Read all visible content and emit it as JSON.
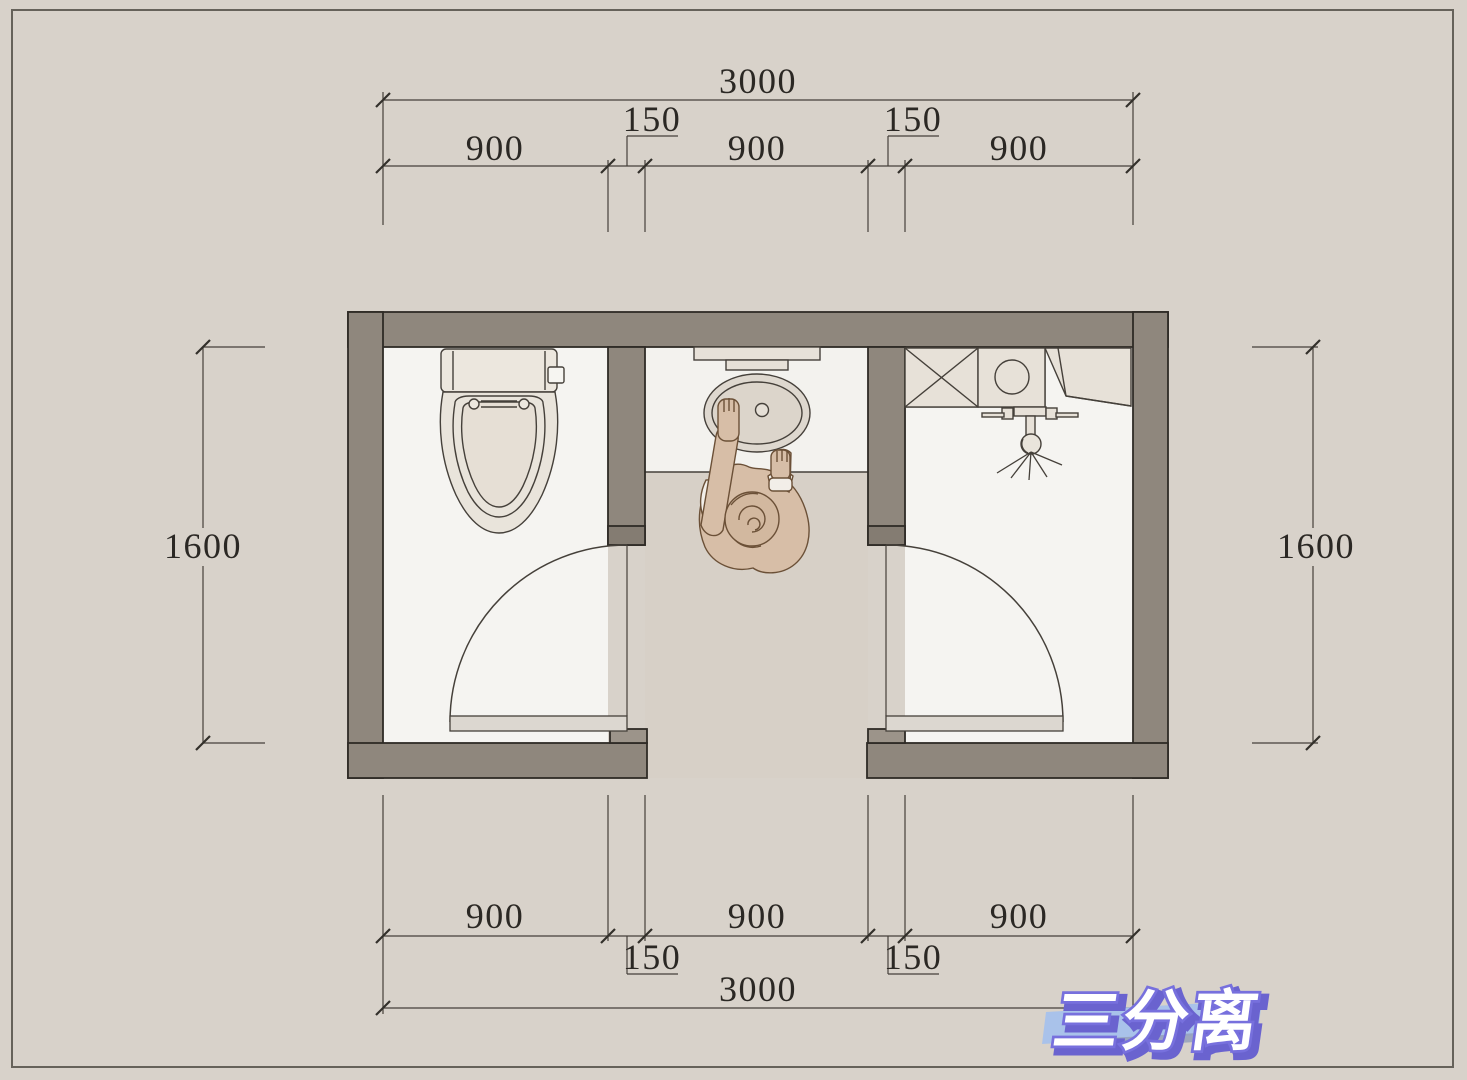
{
  "page": {
    "background_color": "#d8d2ca",
    "frame_color": "#66625a"
  },
  "plan": {
    "type": "bathroom-floor-plan",
    "layout_name": "三分离",
    "rooms": [
      {
        "name": "toilet-compartment",
        "fixtures": [
          "toilet"
        ]
      },
      {
        "name": "vanity-corridor",
        "fixtures": [
          "vanity-counter",
          "oval-washbasin",
          "person-washing-hands"
        ]
      },
      {
        "name": "shower-laundry-compartment",
        "fixtures": [
          "storage-cabinet",
          "washing-machine",
          "shower"
        ]
      }
    ],
    "colors": {
      "wall_fill": "#8f877d",
      "wall_outline": "#2f2b26",
      "room_floor": "#f5f4f1",
      "hall_floor": "#d7d0c7",
      "fixture_fill": "#e9e4db",
      "door_leaf": "#dcd7d0",
      "person_skin": "#d7bea7"
    }
  },
  "dimensions": {
    "top": {
      "total": "3000",
      "segments": [
        "900",
        "900",
        "900"
      ],
      "offsets": [
        "150",
        "150"
      ]
    },
    "bottom": {
      "total": "3000",
      "segments": [
        "900",
        "900",
        "900"
      ],
      "offsets": [
        "150",
        "150"
      ]
    },
    "left": {
      "value": "1600"
    },
    "right": {
      "value": "1600"
    }
  },
  "logo": {
    "text": "三分离",
    "text_color": "#ffffff",
    "outline_color": "#7770dd",
    "shadow_color": "#6a63cf",
    "band_color": "#a9c2ea",
    "strip_color": "#94a0bb"
  }
}
